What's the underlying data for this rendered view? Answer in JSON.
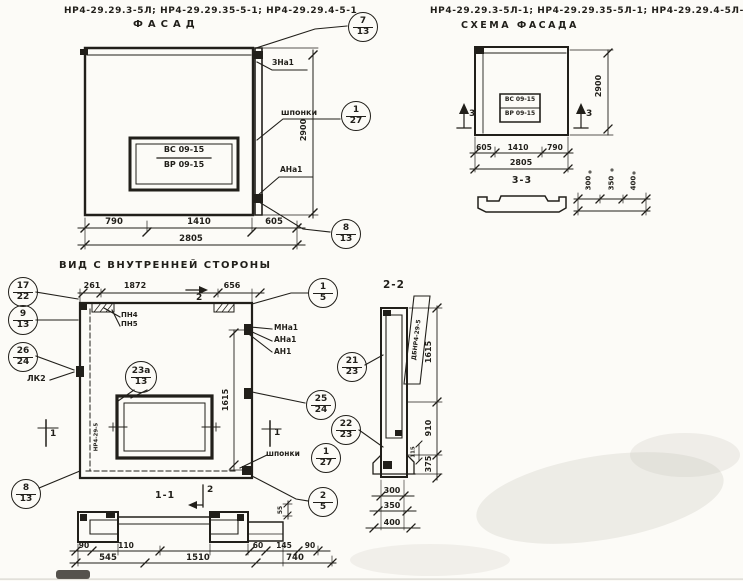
{
  "page": {
    "paper_color": "#fcfbf7",
    "ink_color": "#211f1a"
  },
  "fasad": {
    "header": "НР4-29.29.3-5Л; НР4-29.29.35-5-1; НР4-29.29.4-5-1",
    "title": "ФАСАД",
    "window_mark": {
      "top": "ВС 09-15",
      "bottom": "ВР 09-15"
    },
    "labels": {
      "top_anchor": "ЗНа1",
      "keys": "шпонки",
      "bottom_anchor": "АНа1"
    },
    "callouts": {
      "top": {
        "num": "7",
        "sheet": "13"
      },
      "keys": {
        "num": "1",
        "sheet": "27"
      },
      "bottom": {
        "num": "8",
        "sheet": "13"
      }
    },
    "dims": {
      "w1": "790",
      "w2": "1410",
      "w3": "605",
      "total": "2805",
      "height": "2900"
    }
  },
  "schema": {
    "header": "НР4-29.29.3-5Л-1; НР4-29.29.35-5Л-1; НР4-29.29.4-5Л-1",
    "title": "СХЕМА ФАСАДА",
    "window_mark": {
      "top": "ВС 09-15",
      "bottom": "ВР 09-15"
    },
    "section_mark": "3",
    "dims": {
      "w1": "605",
      "w2": "1410",
      "w3": "790",
      "total": "2805",
      "height": "2900"
    },
    "section33": {
      "title": "3-3",
      "dims": [
        "300",
        "350",
        "400"
      ]
    }
  },
  "inner": {
    "title": "ВИД С ВНУТРЕННЕЙ СТОРОНЫ",
    "dims": {
      "w1": "261",
      "w2": "1872",
      "w3": "656",
      "height": "1615"
    },
    "marks": {
      "section1": "1",
      "section2": "2"
    },
    "labels": {
      "pn4": "ПН4",
      "pn5": "ПН5",
      "mna1": "МНа1",
      "ana1": "АНа1",
      "an1": "АН1",
      "lk2": "ЛК2",
      "keys": "шпонки",
      "side": "НР4-29-5"
    },
    "callouts": {
      "c15": {
        "num": "1",
        "sheet": "5"
      },
      "c1722": {
        "num": "17",
        "sheet": "22"
      },
      "c913": {
        "num": "9",
        "sheet": "13"
      },
      "c2624": {
        "num": "26",
        "sheet": "24"
      },
      "c813": {
        "num": "8",
        "sheet": "13"
      },
      "c23a13": {
        "num": "23а",
        "sheet": "13"
      },
      "c2123": {
        "num": "21",
        "sheet": "23"
      },
      "c2524": {
        "num": "25",
        "sheet": "24"
      },
      "c2223": {
        "num": "22",
        "sheet": "23"
      },
      "c127": {
        "num": "1",
        "sheet": "27"
      },
      "c25": {
        "num": "2",
        "sheet": "5"
      }
    }
  },
  "section22": {
    "title": "2-2",
    "label": "ДБНР4-29-5",
    "dims": {
      "top": "1615",
      "mid": "910",
      "bottom": "375",
      "small": "115",
      "widths": [
        "300",
        "350",
        "400"
      ]
    }
  },
  "section11": {
    "title": "1-1",
    "mark": "2",
    "dims_row1": [
      "90",
      "110",
      "60",
      "145",
      "90"
    ],
    "dims_row2": [
      "545",
      "1510",
      "740"
    ],
    "dim_small": "55"
  }
}
